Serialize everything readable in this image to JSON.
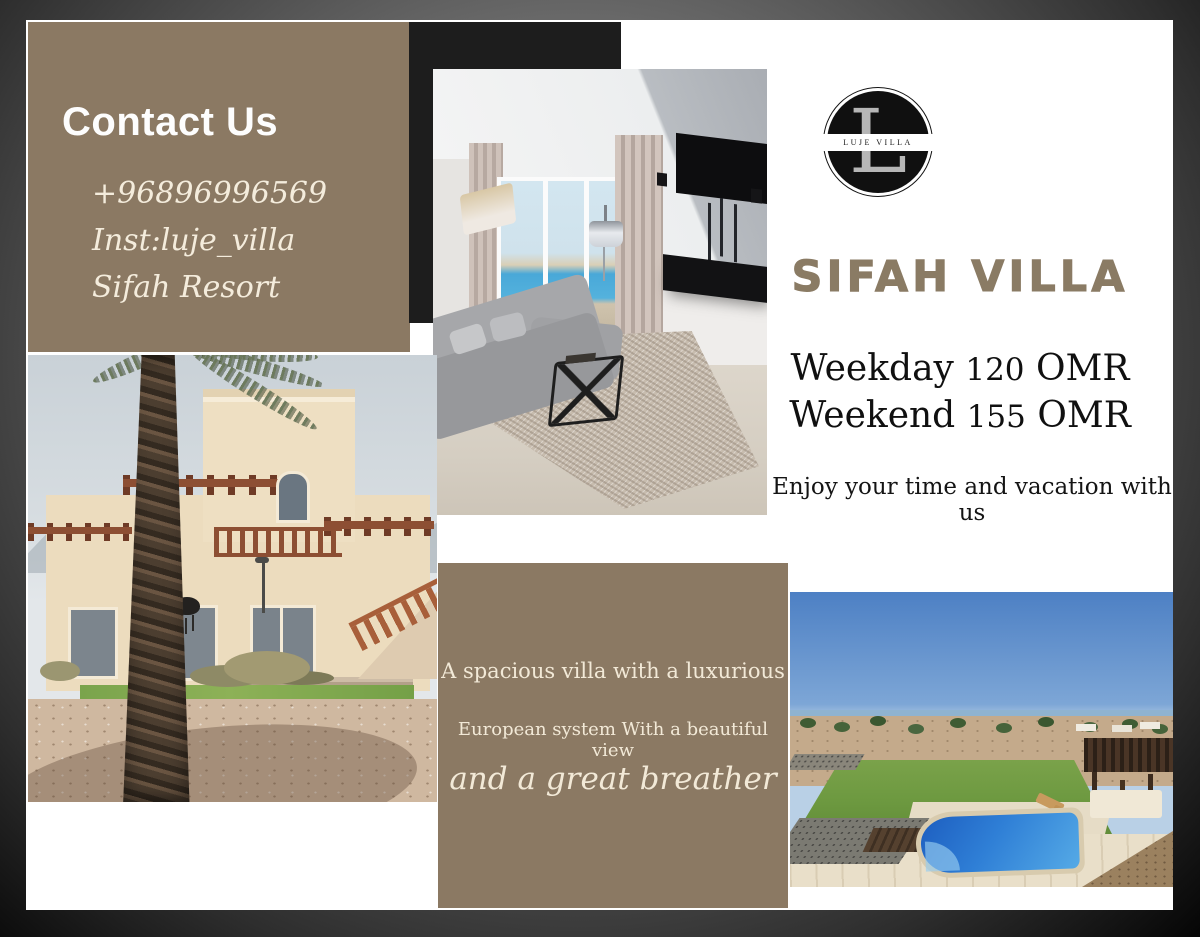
{
  "contact": {
    "heading": "Contact Us",
    "phone": "+96896996569",
    "instagram": "Inst:luje_villa",
    "location": "Sifah Resort"
  },
  "logo": {
    "monogram": "L",
    "band_text": "LUJE VILLA"
  },
  "title": "SIFAH VILLA",
  "pricing": {
    "rates": [
      {
        "label": "Weekday",
        "amount": "120",
        "currency": "OMR"
      },
      {
        "label": "Weekend",
        "amount": "155",
        "currency": "OMR"
      }
    ],
    "tagline": "Enjoy your time and vacation with us"
  },
  "description": {
    "line1": "A spacious villa with a luxurious",
    "line2": "European system With a beautiful view",
    "line3": "and a great breather"
  },
  "photos": {
    "living_room": "living-room-interior",
    "villa_exterior": "villa-exterior-with-palm",
    "pool": "pool-and-garden"
  },
  "colors": {
    "brown_panel": "#8b7963",
    "black_panel": "#1d1d1d",
    "cream_text": "#f2e9d7",
    "title_brown": "#8a7b64",
    "pool_blue": "#1d5ec0"
  }
}
